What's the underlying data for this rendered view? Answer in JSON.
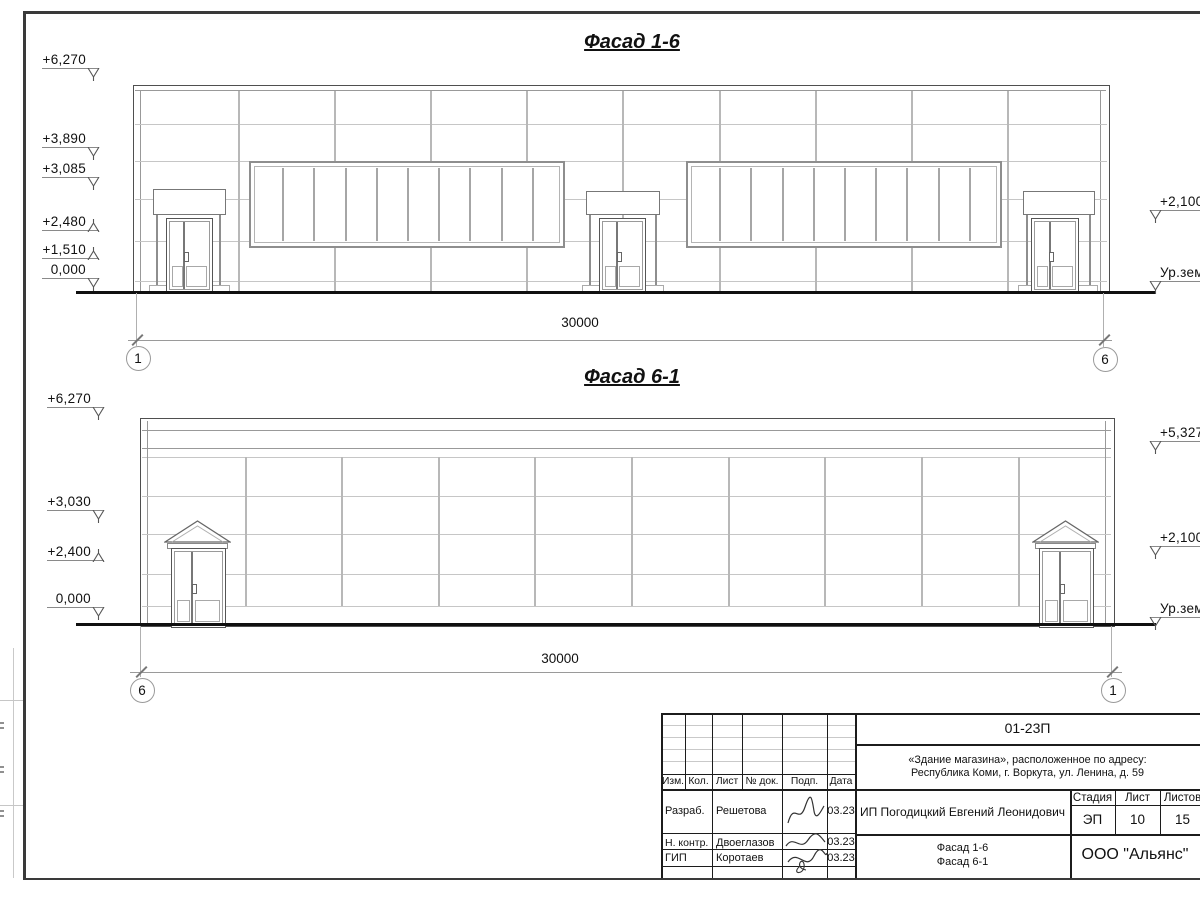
{
  "facade1": {
    "title": "Фасад 1-6",
    "marks_left": [
      "+6,270",
      "+3,890",
      "+3,085",
      "+2,480",
      "+1,510",
      "0,000"
    ],
    "marks_right": [
      "+2,100",
      "Ур.зем"
    ],
    "dimension": "30000",
    "axis_left": "1",
    "axis_right": "6"
  },
  "facade2": {
    "title": "Фасад 6-1",
    "marks_left": [
      "+6,270",
      "+3,030",
      "+2,400",
      "0,000"
    ],
    "marks_right": [
      "+5,327",
      "+2,100",
      "Ур.зем"
    ],
    "dimension": "30000",
    "axis_left": "6",
    "axis_right": "1"
  },
  "title_block": {
    "doc_number": "01-23П",
    "object_address_line1": "«Здание магазина», расположенное по адресу:",
    "object_address_line2": "Республика Коми, г. Воркута, ул. Ленина, д. 59",
    "header_cols": [
      "Изм.",
      "Кол.",
      "Лист",
      "№ док.",
      "Подп.",
      "Дата"
    ],
    "signature_rows": [
      {
        "role": "Разраб.",
        "name": "Решетова",
        "date": "03.23"
      },
      {
        "role": "Н. контр.",
        "name": "Двоеглазов",
        "date": "03.23"
      },
      {
        "role": "ГИП",
        "name": "Коротаев",
        "date": "03.23"
      }
    ],
    "client": "ИП Погодицкий Евгений Леонидович",
    "stage_label": "Стадия",
    "stage_value": "ЭП",
    "sheet_label": "Лист",
    "sheet_value": "10",
    "sheets_label": "Листов",
    "sheets_value": "15",
    "drawing_title_line1": "Фасад 1-6",
    "drawing_title_line2": "Фасад 6-1",
    "organization": "ООО \"Альянс\""
  }
}
